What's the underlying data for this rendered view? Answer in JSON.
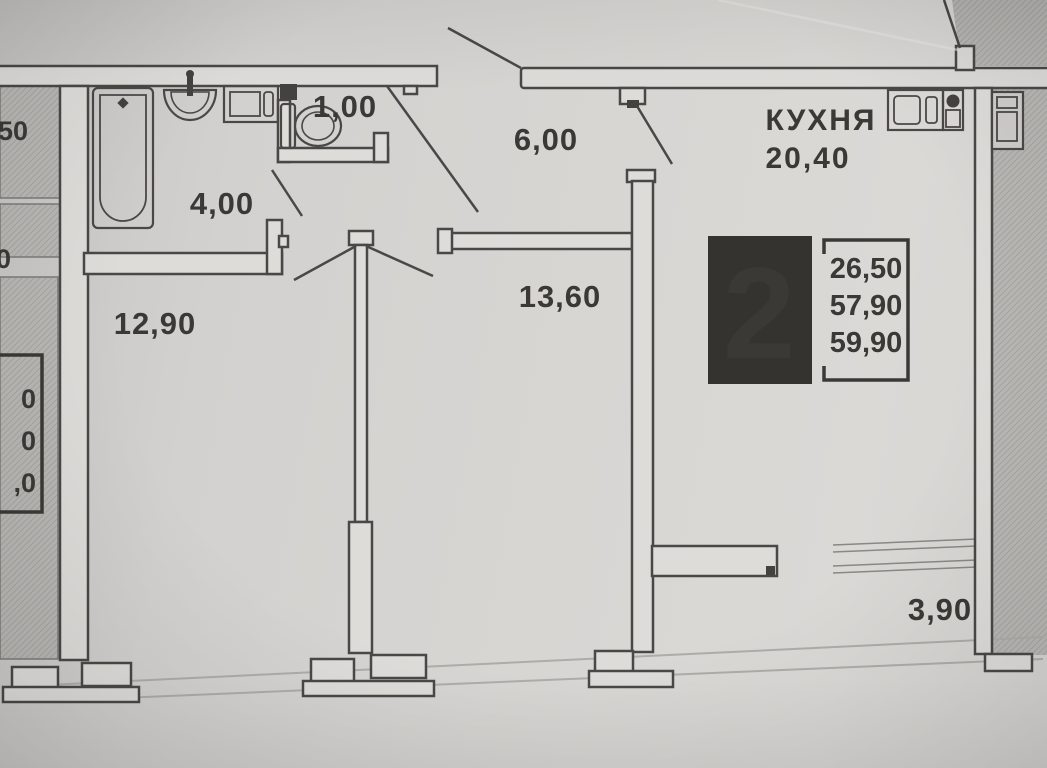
{
  "plan": {
    "type": "apartment-floor-plan",
    "rooms": {
      "wc": {
        "area_label": "1,00"
      },
      "bathroom": {
        "area_label": "4,00"
      },
      "hallway": {
        "area_label": "6,00"
      },
      "room_left": {
        "area_label": "12,90"
      },
      "room_mid": {
        "area_label": "13,60"
      },
      "kitchen": {
        "name": "КУХНЯ",
        "area_label": "20,40"
      },
      "balcony": {
        "area_label": "3,90"
      }
    },
    "badge": {
      "rooms_count": "2",
      "living_area": "26,50",
      "apartment_area": "57,90",
      "total_area": "59,90"
    },
    "adjacent_unit_partials": {
      "top_label": "50",
      "mid_label": "0",
      "badge_line1": "0",
      "badge_line2": "0",
      "badge_line3": ",0"
    },
    "colors": {
      "paper": "#d8d6d3",
      "line": "#4a4846",
      "text": "#3b3936",
      "badge_black": "#35332f",
      "hatch_fill": "#bab8b5"
    }
  }
}
